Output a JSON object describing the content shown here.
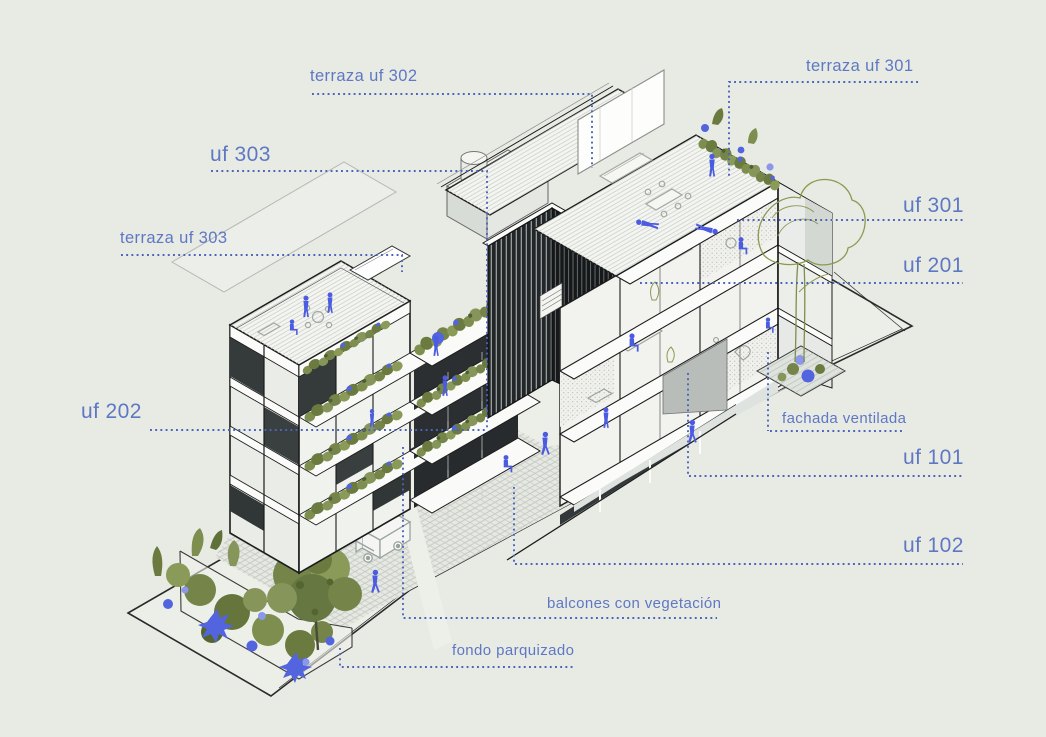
{
  "labels": {
    "terraza_uf_302": "terraza uf 302",
    "terraza_uf_301": "terraza uf 301",
    "uf_303": "uf 303",
    "terraza_uf_303": "terraza uf 303",
    "uf_301": "uf 301",
    "uf_201": "uf 201",
    "uf_202": "uf 202",
    "fachada_ventilada": "fachada ventilada",
    "uf_101": "uf 101",
    "uf_102": "uf 102",
    "balcones_con_vegetacion": "balcones con vegetación",
    "fondo_parquizado": "fondo parquizado"
  },
  "colors": {
    "background": "#e8eae4",
    "annotation_blue": "#5f78c3",
    "leader_dot_blue": "#4c63bb",
    "people_blue": "#4b5ce0",
    "vegetation_green": "#7d8e4e",
    "line_dark": "#1c1c1c"
  }
}
